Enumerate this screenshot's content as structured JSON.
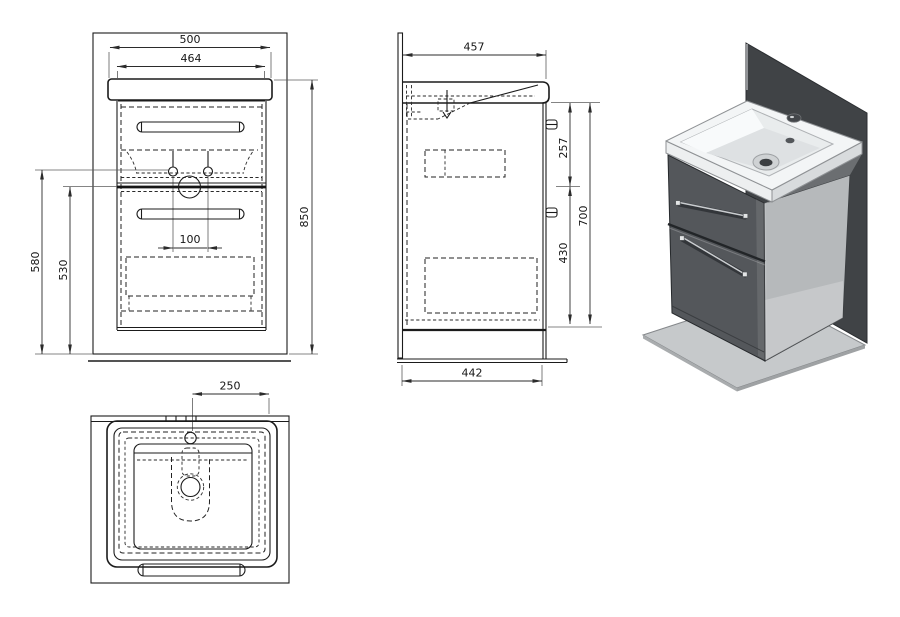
{
  "drawing": {
    "front_view": {
      "dims": {
        "total_width": "500",
        "cabinet_width": "464",
        "total_height": "850",
        "outlet_height": "580",
        "inner_height": "530",
        "tap_spacing": "100"
      }
    },
    "side_view": {
      "dims": {
        "total_depth": "457",
        "upper_section": "257",
        "cabinet_height": "700",
        "lower_section": "430",
        "plate_depth": "442"
      }
    },
    "top_view": {
      "dims": {
        "tap_center_offset": "250"
      }
    }
  },
  "render3d": {
    "colors": {
      "back_panel": "#404346",
      "base_plate": "#c6c9cb",
      "cabinet_front": "#54575b",
      "cabinet_side": "#b6b9bb",
      "basin_top": "#f3f5f6",
      "basin_band_left": "#edeff0",
      "basin_band_right": "#d8dbdd",
      "bowl": "#e9eced",
      "handle": "#33363a"
    }
  }
}
